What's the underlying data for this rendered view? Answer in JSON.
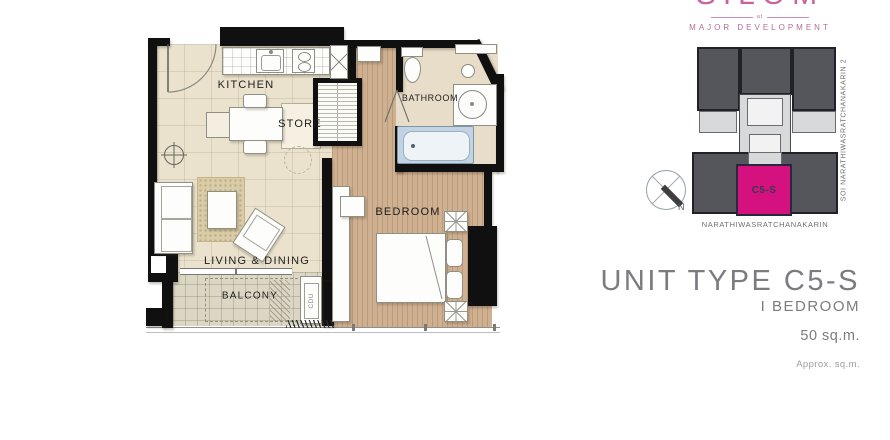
{
  "logo": {
    "brand": "SILOM",
    "connector": "at",
    "developer": "MAJOR DEVELOPMENT",
    "brand_color": "#c7649f"
  },
  "floor_plan": {
    "labels": {
      "kitchen": "KITCHEN",
      "store": "STORE",
      "bathroom": "BATHROOM",
      "bedroom": "BEDROOM",
      "living_dining": "LIVING & DINING",
      "balcony": "BALCONY",
      "cdu": "CDU"
    }
  },
  "key_plan": {
    "unit_label": "C5-S",
    "compass": "N",
    "street_bottom": "NARATHIWASRATCHANAKARIN",
    "street_right": "SOI NARATHIWASRATCHANAKARIN 2",
    "colors": {
      "highlight": "#d4117e",
      "building_dark": "#55565c",
      "building_light": "#d8d9da"
    }
  },
  "title_block": {
    "title": "UNIT TYPE C5-S",
    "bedrooms": "I BEDROOM",
    "area": "50 sq.m.",
    "note": "Approx. sq.m."
  }
}
